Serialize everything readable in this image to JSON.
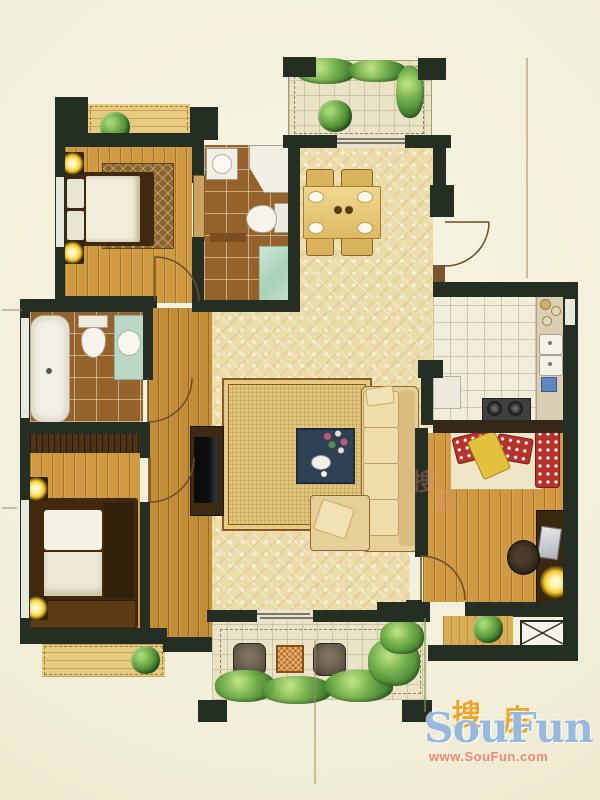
{
  "watermark": {
    "hanzi_left": "搜",
    "hanzi_right": "房",
    "brand": "SouFun",
    "url": "www.SouFun.com"
  },
  "ghost_watermark": {
    "hanzi_left": "搜",
    "hanzi_right": "房"
  },
  "palette": {
    "wall": "#242e22",
    "wood": "#cf9a42",
    "wood_light": "#e7cb7e",
    "carpet": "#ebdcaa",
    "tile_brown": "#96622c",
    "tile_white": "#f2edda",
    "rug": "#e0c67c",
    "sofa": "#e6d098",
    "navy_table": "#2e4152",
    "duvet": "#f1edda",
    "bedframe": "#3f2a10",
    "red": "#b5332b",
    "yellow": "#e2c23c",
    "glow": "#f6c826",
    "teal_glass": "#bcd8c4",
    "counter": "#dacfb2",
    "wm_blue": "#98b9de",
    "wm_orange": "#f0a42c",
    "wm_pink": "#ee8a74",
    "dim_line": "#9b8a5c"
  },
  "floor_plan": {
    "type": "residential-floor-plan",
    "rooms": [
      {
        "id": "master-bedroom",
        "fixtures": [
          "double-bed",
          "nightstand-lamps",
          "foot-rug",
          "window"
        ]
      },
      {
        "id": "ensuite-bathroom",
        "fixtures": [
          "washbasin",
          "corner-shower",
          "toilet",
          "glass-stall",
          "shelf"
        ]
      },
      {
        "id": "north-west-balcony",
        "fixtures": [
          "potted-plant"
        ]
      },
      {
        "id": "north-balcony",
        "fixtures": [
          "planting-bed",
          "potted-plant",
          "sliding-door"
        ]
      },
      {
        "id": "dining-area",
        "fixtures": [
          "dining-table",
          "four-chairs",
          "place-settings"
        ]
      },
      {
        "id": "entry",
        "fixtures": [
          "entry-door"
        ]
      },
      {
        "id": "kitchen",
        "fixtures": [
          "counter",
          "double-sink",
          "gas-stove",
          "prep-table"
        ]
      },
      {
        "id": "hallway",
        "fixtures": []
      },
      {
        "id": "bathroom",
        "fixtures": [
          "bathtub",
          "toilet",
          "vanity-basin"
        ]
      },
      {
        "id": "west-bedroom",
        "fixtures": [
          "wardrobe",
          "double-bed",
          "nightstand-lamps",
          "window"
        ]
      },
      {
        "id": "south-west-balcony",
        "fixtures": [
          "potted-plant"
        ]
      },
      {
        "id": "living-room",
        "fixtures": [
          "l-sofa",
          "chaise",
          "coffee-table",
          "tv-cabinet",
          "area-rug"
        ]
      },
      {
        "id": "south-east-bedroom",
        "fixtures": [
          "bed-red-pillows",
          "desk",
          "chair",
          "desk-lamp"
        ]
      },
      {
        "id": "terrace",
        "fixtures": [
          "two-chairs",
          "side-table",
          "shrubs",
          "sliding-door"
        ]
      },
      {
        "id": "elevator",
        "fixtures": [
          "elevator-shaft-x"
        ]
      }
    ]
  }
}
